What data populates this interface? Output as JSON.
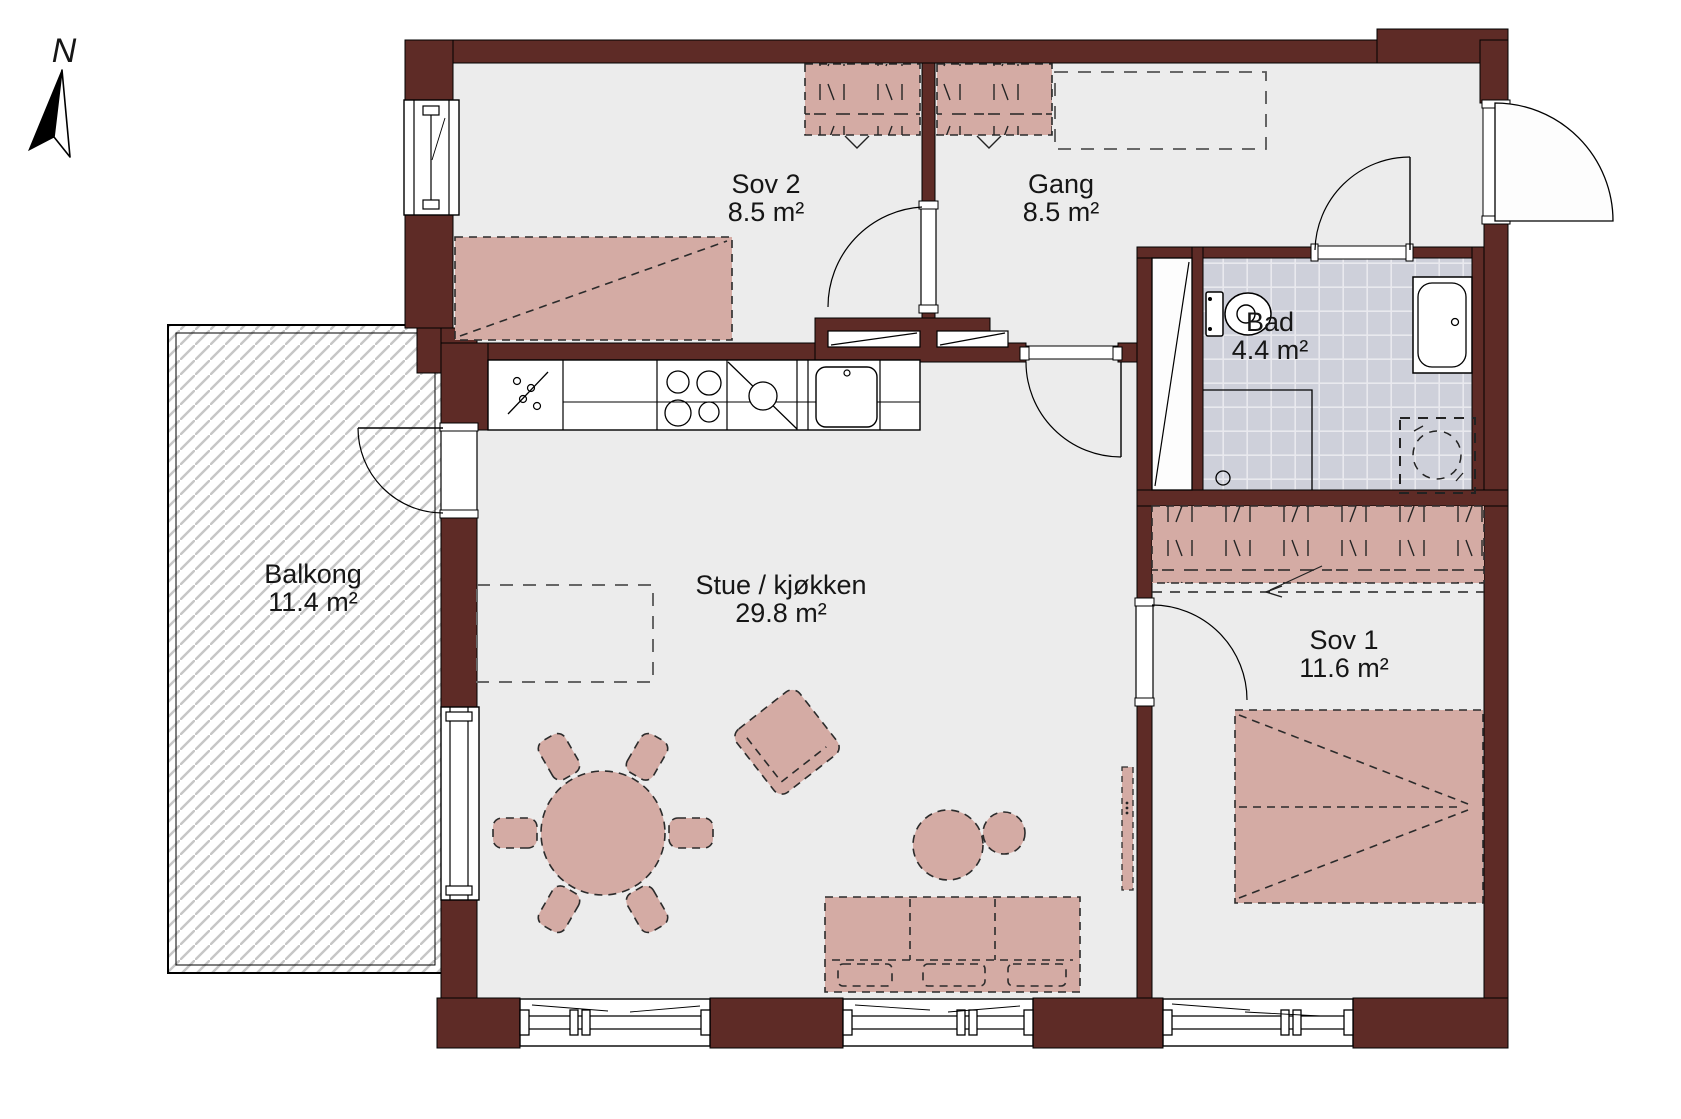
{
  "compass": {
    "label": "N"
  },
  "rooms": [
    {
      "id": "sov2",
      "label": "Sov 2",
      "area": "8.5 m²"
    },
    {
      "id": "gang",
      "label": "Gang",
      "area": "8.5 m²"
    },
    {
      "id": "bad",
      "label": "Bad",
      "area": "4.4 m²"
    },
    {
      "id": "stue",
      "label": "Stue / kjøkken",
      "area": "29.8 m²"
    },
    {
      "id": "sov1",
      "label": "Sov 1",
      "area": "11.6 m²"
    },
    {
      "id": "balkong",
      "label": "Balkong",
      "area": "11.4 m²"
    }
  ],
  "colors": {
    "wall": "#5e2b26",
    "floor": "#ececec",
    "furniture": "#d4aba4",
    "furniture_outline": "#2b2b2b",
    "bath_tile": "#ced0da",
    "tile_grout": "#e9e9ee",
    "balcony_hatch": "#c6c6c6",
    "line": "#000000"
  }
}
